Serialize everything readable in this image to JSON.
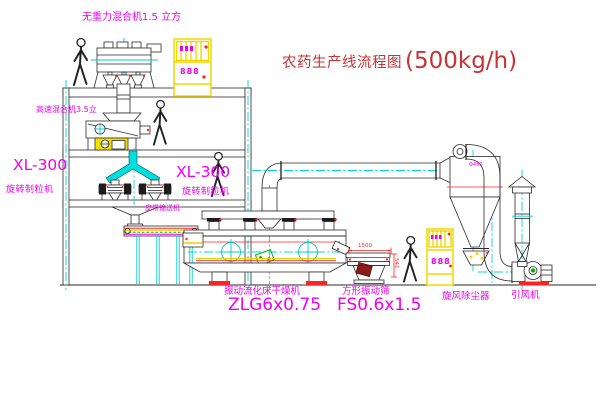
{
  "title": {
    "name": "农药生产线流程图",
    "capacity": "(500kg/h)"
  },
  "palette": {
    "line": "#2a2a2a",
    "centerline_cyan": "#00d8d8",
    "label_magenta": "#ee00ee",
    "dimension_red": "#ff2222",
    "cabinet_yellow": "#f0d800",
    "detail_green": "#00b400",
    "title_red": "#c43434",
    "background": "#ffffff"
  },
  "labels": {
    "top_mixer": "无重力混合机1.5 立方",
    "mid_mixer": "高速混合机3.5立",
    "granulator_left_model": "XL-300",
    "granulator_left_name": "旋转制粒机",
    "granulator_right_model": "XL-300",
    "granulator_right_name": "旋转制粒机",
    "belt_conveyor": "皮带输送机",
    "dryer_name": "振动流化床干燥机",
    "dryer_model": "ZLG6x0.75",
    "sieve_name": "方形振动筛",
    "sieve_model": "FS0.6x1.5",
    "cyclone_name": "旋风除尘器",
    "fan_name": "引风机"
  },
  "dimensions": {
    "sieve_length": "1500",
    "sieve_height": "541",
    "cyclone_note": "Φ480"
  },
  "cabinets": {
    "left_display": "888",
    "right_display": "888"
  }
}
